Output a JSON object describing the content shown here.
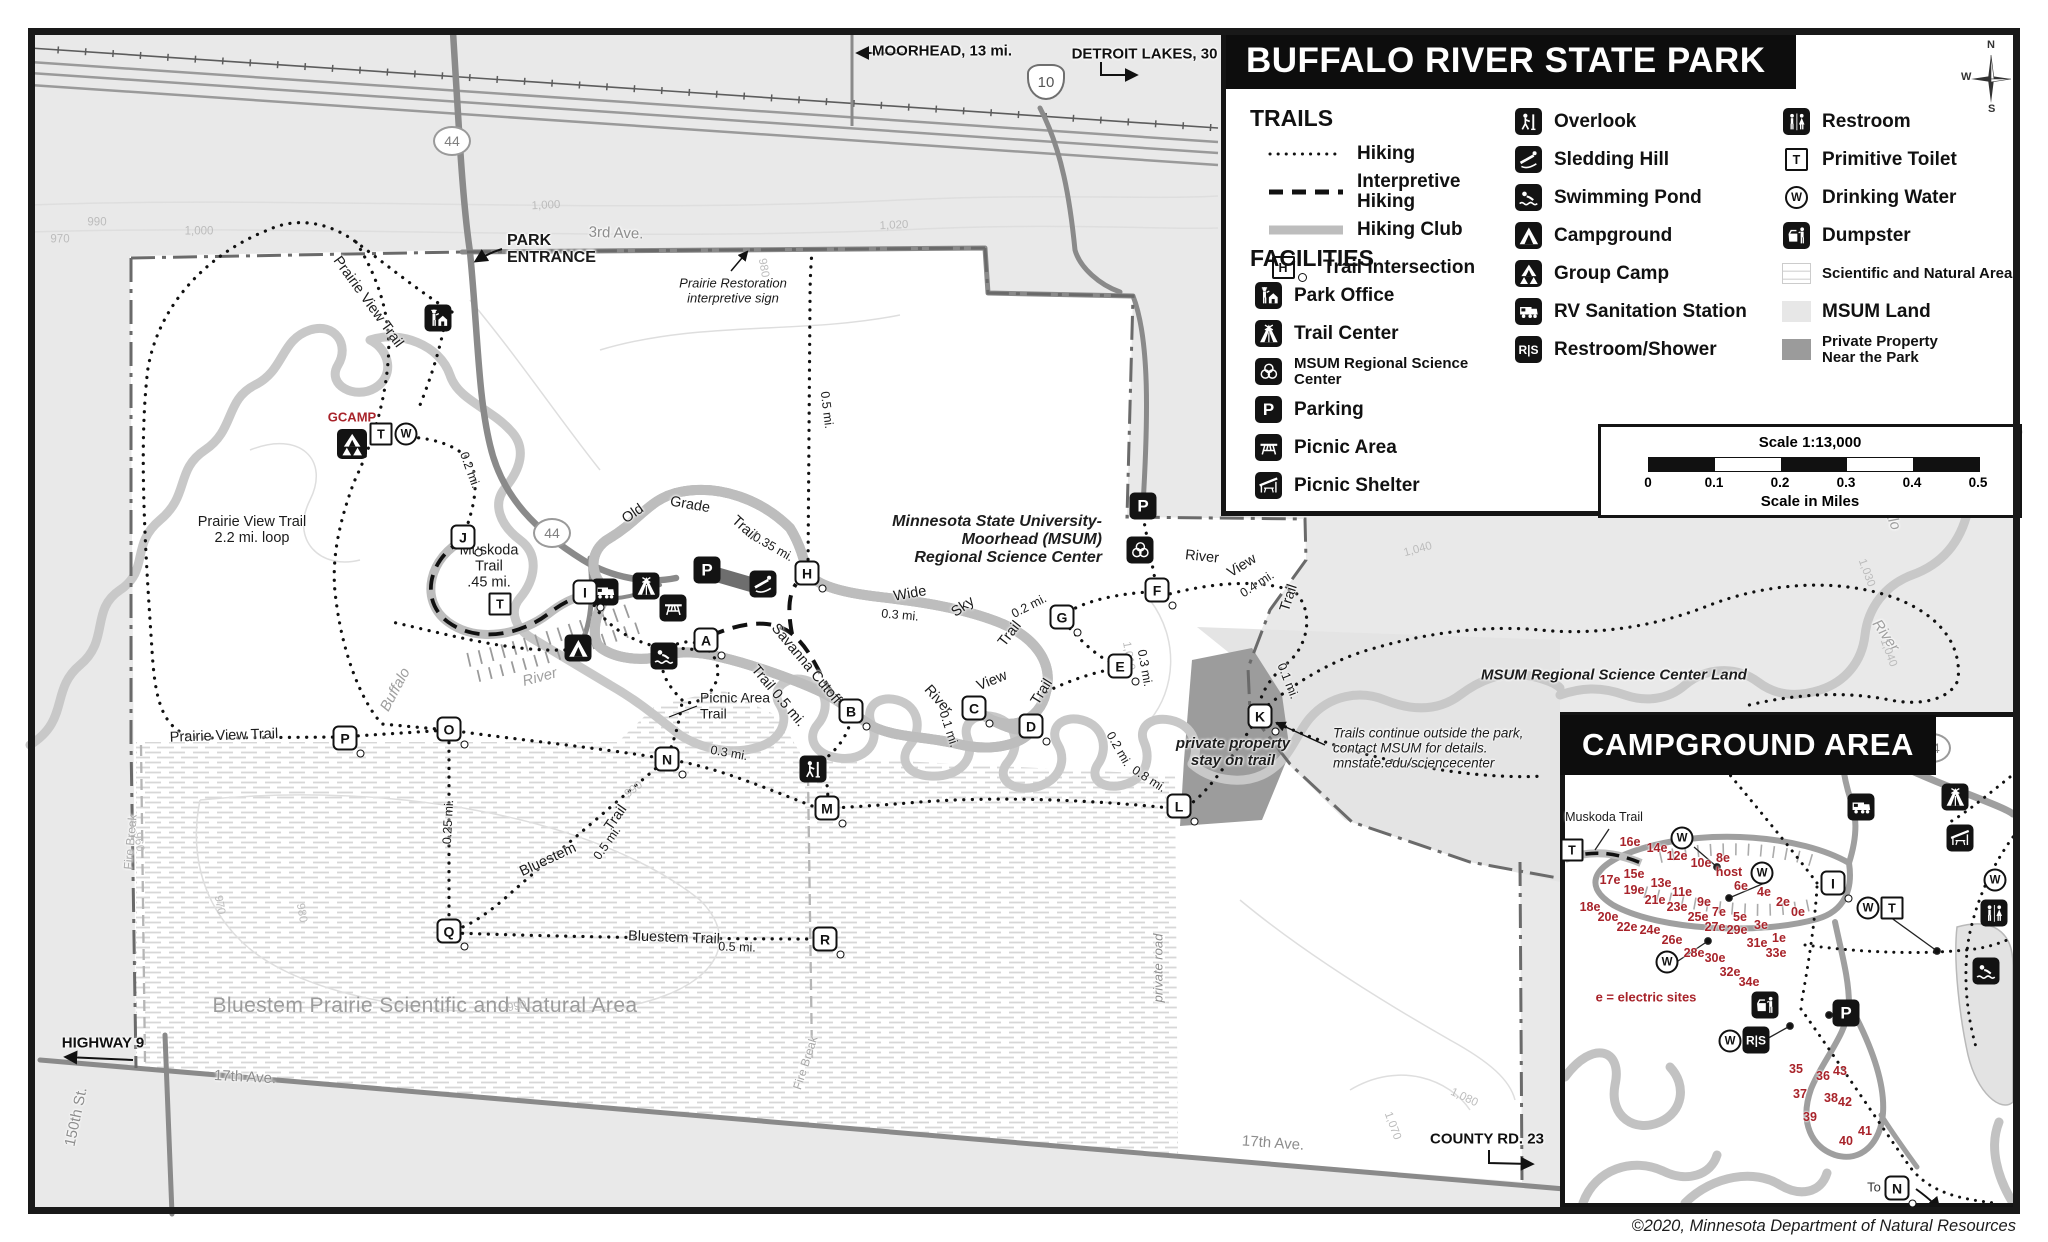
{
  "page": {
    "copyright": "©2020, Minnesota Department of Natural Resources"
  },
  "header": {
    "title": "BUFFALO RIVER STATE PARK"
  },
  "compass": {
    "n": "N",
    "e": "E",
    "s": "S",
    "w": "W"
  },
  "icon_glyphs": {
    "P": "P",
    "RS": "R|S",
    "T": "T",
    "W": "W",
    "H": "H"
  },
  "legend": {
    "trails_heading": "TRAILS",
    "trails": [
      {
        "style": "dotted",
        "label": "Hiking"
      },
      {
        "style": "dashed",
        "label": "Interpretive Hiking"
      },
      {
        "style": "club",
        "label": "Hiking Club"
      },
      {
        "style": "intersection",
        "symbol": "H",
        "label": "Trail Intersection"
      }
    ],
    "facilities_heading": "FACILITIES",
    "columns": [
      [
        {
          "icon": "b-office",
          "label": "Park Office"
        },
        {
          "icon": "b-lodge",
          "label": "Trail Center"
        },
        {
          "icon": "b-rings",
          "label": "MSUM Regional Science Center",
          "small": true
        },
        {
          "icon": "b-P",
          "label": "Parking"
        },
        {
          "icon": "b-picnic",
          "label": "Picnic Area"
        },
        {
          "icon": "b-shelter",
          "label": "Picnic Shelter"
        }
      ],
      [
        {
          "icon": "b-look",
          "label": "Overlook"
        },
        {
          "icon": "b-sled",
          "label": "Sledding Hill"
        },
        {
          "icon": "b-swim",
          "label": "Swimming Pond"
        },
        {
          "icon": "b-tent",
          "label": "Campground"
        },
        {
          "icon": "b-gcamp",
          "label": "Group Camp"
        },
        {
          "icon": "b-rv",
          "label": "RV Sanitation Station"
        },
        {
          "icon": "b-RS",
          "label": "Restroom/Shower"
        }
      ],
      [
        {
          "icon": "b-wc",
          "label": "Restroom"
        },
        {
          "icon": "w-T",
          "label": "Primitive Toilet"
        },
        {
          "icon": "c-W",
          "label": "Drinking Water"
        },
        {
          "icon": "b-dump",
          "label": "Dumpster"
        },
        {
          "icon": "sw-sna",
          "label": "Scientific and Natural Area",
          "small": true
        },
        {
          "icon": "sw-msum",
          "label": "MSUM Land"
        },
        {
          "icon": "sw-priv",
          "label": "Private Property\nNear the Park",
          "small": true
        }
      ]
    ]
  },
  "scalebar": {
    "title": "Scale 1:13,000",
    "ticks": [
      "0",
      "0.1",
      "0.2",
      "0.3",
      "0.4",
      "0.5"
    ],
    "caption": "Scale in Miles"
  },
  "inset": {
    "title": "CAMPGROUND AREA",
    "to_label": "To",
    "sites": [
      {
        "t": "16e",
        "x": 1630,
        "y": 842
      },
      {
        "t": "14e",
        "x": 1657,
        "y": 848
      },
      {
        "t": "12e",
        "x": 1677,
        "y": 856
      },
      {
        "t": "10e",
        "x": 1701,
        "y": 863
      },
      {
        "t": "8e",
        "x": 1723,
        "y": 858
      },
      {
        "t": "host",
        "x": 1729,
        "y": 872
      },
      {
        "t": "6e",
        "x": 1741,
        "y": 886
      },
      {
        "t": "4e",
        "x": 1764,
        "y": 892
      },
      {
        "t": "2e",
        "x": 1783,
        "y": 902
      },
      {
        "t": "0e",
        "x": 1798,
        "y": 912
      },
      {
        "t": "15e",
        "x": 1634,
        "y": 874
      },
      {
        "t": "13e",
        "x": 1661,
        "y": 883
      },
      {
        "t": "11e",
        "x": 1682,
        "y": 892
      },
      {
        "t": "9e",
        "x": 1704,
        "y": 902
      },
      {
        "t": "7e",
        "x": 1719,
        "y": 912
      },
      {
        "t": "5e",
        "x": 1740,
        "y": 917
      },
      {
        "t": "3e",
        "x": 1761,
        "y": 925
      },
      {
        "t": "1e",
        "x": 1779,
        "y": 938
      },
      {
        "t": "17e",
        "x": 1610,
        "y": 880
      },
      {
        "t": "19e",
        "x": 1634,
        "y": 890
      },
      {
        "t": "21e",
        "x": 1655,
        "y": 900
      },
      {
        "t": "23e",
        "x": 1677,
        "y": 907
      },
      {
        "t": "25e",
        "x": 1698,
        "y": 917
      },
      {
        "t": "27e",
        "x": 1715,
        "y": 927
      },
      {
        "t": "29e",
        "x": 1737,
        "y": 930
      },
      {
        "t": "31e",
        "x": 1757,
        "y": 943
      },
      {
        "t": "33e",
        "x": 1776,
        "y": 953
      },
      {
        "t": "18e",
        "x": 1590,
        "y": 907
      },
      {
        "t": "20e",
        "x": 1608,
        "y": 917
      },
      {
        "t": "22e",
        "x": 1627,
        "y": 927
      },
      {
        "t": "24e",
        "x": 1650,
        "y": 930
      },
      {
        "t": "26e",
        "x": 1672,
        "y": 940
      },
      {
        "t": "28e",
        "x": 1694,
        "y": 953
      },
      {
        "t": "30e",
        "x": 1715,
        "y": 958
      },
      {
        "t": "32e",
        "x": 1730,
        "y": 972
      },
      {
        "t": "34e",
        "x": 1749,
        "y": 982
      },
      {
        "t": "35",
        "x": 1796,
        "y": 1069
      },
      {
        "t": "36",
        "x": 1823,
        "y": 1076
      },
      {
        "t": "43",
        "x": 1840,
        "y": 1071
      },
      {
        "t": "37",
        "x": 1800,
        "y": 1094
      },
      {
        "t": "38",
        "x": 1831,
        "y": 1098
      },
      {
        "t": "42",
        "x": 1845,
        "y": 1102
      },
      {
        "t": "39",
        "x": 1810,
        "y": 1117
      },
      {
        "t": "40",
        "x": 1846,
        "y": 1141
      },
      {
        "t": "41",
        "x": 1865,
        "y": 1131
      }
    ]
  },
  "map": {
    "shields": [
      {
        "t": "10",
        "x": 1046,
        "y": 82,
        "us": 1
      },
      {
        "t": "44",
        "x": 452,
        "y": 141
      },
      {
        "t": "44",
        "x": 552,
        "y": 533
      },
      {
        "t": "44",
        "x": 1932,
        "y": 748
      }
    ],
    "intersections": [
      {
        "t": "A",
        "x": 706,
        "y": 640
      },
      {
        "t": "B",
        "x": 851,
        "y": 711
      },
      {
        "t": "C",
        "x": 974,
        "y": 708
      },
      {
        "t": "D",
        "x": 1031,
        "y": 726
      },
      {
        "t": "E",
        "x": 1120,
        "y": 666
      },
      {
        "t": "F",
        "x": 1157,
        "y": 590
      },
      {
        "t": "G",
        "x": 1062,
        "y": 617
      },
      {
        "t": "H",
        "x": 807,
        "y": 573
      },
      {
        "t": "I",
        "x": 585,
        "y": 592
      },
      {
        "t": "J",
        "x": 463,
        "y": 537
      },
      {
        "t": "K",
        "x": 1260,
        "y": 716
      },
      {
        "t": "L",
        "x": 1179,
        "y": 806
      },
      {
        "t": "M",
        "x": 827,
        "y": 808
      },
      {
        "t": "N",
        "x": 667,
        "y": 759
      },
      {
        "t": "O",
        "x": 449,
        "y": 729
      },
      {
        "t": "P",
        "x": 345,
        "y": 738
      },
      {
        "t": "Q",
        "x": 449,
        "y": 931
      },
      {
        "t": "R",
        "x": 825,
        "y": 939
      },
      {
        "t": "I",
        "x": 1833,
        "y": 883
      },
      {
        "t": "N",
        "x": 1897,
        "y": 1188
      }
    ],
    "icons": [
      {
        "k": "b-office",
        "x": 438,
        "y": 318
      },
      {
        "k": "b-gcamp",
        "x": 352,
        "y": 444,
        "s": 30
      },
      {
        "k": "w-T",
        "x": 381,
        "y": 434
      },
      {
        "k": "c-W",
        "x": 406,
        "y": 434
      },
      {
        "k": "b-rv",
        "x": 605,
        "y": 592
      },
      {
        "k": "b-lodge",
        "x": 646,
        "y": 586
      },
      {
        "k": "b-P",
        "x": 707,
        "y": 570
      },
      {
        "k": "b-picnic",
        "x": 673,
        "y": 608
      },
      {
        "k": "b-sled",
        "x": 763,
        "y": 584
      },
      {
        "k": "b-tent",
        "x": 578,
        "y": 648
      },
      {
        "k": "b-swim",
        "x": 664,
        "y": 656
      },
      {
        "k": "w-T",
        "x": 500,
        "y": 604
      },
      {
        "k": "b-P",
        "x": 1143,
        "y": 506
      },
      {
        "k": "b-rings",
        "x": 1140,
        "y": 550
      },
      {
        "k": "b-look",
        "x": 813,
        "y": 769
      },
      {
        "k": "b-rv",
        "x": 1861,
        "y": 807
      },
      {
        "k": "b-lodge",
        "x": 1955,
        "y": 797
      },
      {
        "k": "b-shelter",
        "x": 1960,
        "y": 838
      },
      {
        "k": "b-wc",
        "x": 1994,
        "y": 913
      },
      {
        "k": "b-swim",
        "x": 1986,
        "y": 971
      },
      {
        "k": "b-dump",
        "x": 1765,
        "y": 1005
      },
      {
        "k": "b-P",
        "x": 1846,
        "y": 1013
      },
      {
        "k": "b-RS",
        "x": 1756,
        "y": 1040
      },
      {
        "k": "c-W",
        "x": 1682,
        "y": 838
      },
      {
        "k": "c-W",
        "x": 1762,
        "y": 873
      },
      {
        "k": "c-W",
        "x": 1667,
        "y": 962
      },
      {
        "k": "c-W",
        "x": 1995,
        "y": 880
      },
      {
        "k": "c-W",
        "x": 1868,
        "y": 908
      },
      {
        "k": "c-W",
        "x": 1730,
        "y": 1041
      },
      {
        "k": "w-T",
        "x": 1572,
        "y": 850
      },
      {
        "k": "w-T",
        "x": 1892,
        "y": 908
      }
    ],
    "labels": [
      {
        "t": "MOORHEAD, 13 mi.",
        "x": 942,
        "y": 52,
        "c": "c-sign"
      },
      {
        "t": "DETROIT LAKES, 30 Mi.",
        "x": 1157,
        "y": 55,
        "c": "c-sign"
      },
      {
        "t": "HIGHWAY 9",
        "x": 103,
        "y": 1044,
        "c": "c-sign"
      },
      {
        "t": "COUNTY RD. 23",
        "x": 1487,
        "y": 1140,
        "c": "c-sign"
      },
      {
        "t": "PARK\nENTRANCE",
        "x": 507,
        "y": 250,
        "c": "c-pe",
        "a": "l"
      },
      {
        "t": "3rd Ave.",
        "x": 616,
        "y": 234,
        "r": 2,
        "c": "c-road"
      },
      {
        "t": "17th Ave.",
        "x": 245,
        "y": 1078,
        "r": 3,
        "c": "c-road"
      },
      {
        "t": "17th Ave.",
        "x": 1273,
        "y": 1144,
        "r": 4,
        "c": "c-road"
      },
      {
        "t": "150th St.",
        "x": 77,
        "y": 1117,
        "r": -78,
        "c": "c-road"
      },
      {
        "t": "private road",
        "x": 1159,
        "y": 968,
        "r": -90,
        "c": "c-roadi"
      },
      {
        "t": "Fire Break",
        "x": 131,
        "y": 842,
        "r": -85,
        "c": "c-fire"
      },
      {
        "t": "Fire Break",
        "x": 806,
        "y": 1063,
        "r": -72,
        "c": "c-fire"
      },
      {
        "t": "Prairie Restoration\ninterpretive sign",
        "x": 733,
        "y": 291,
        "c": "c-note"
      },
      {
        "t": "Trails continue outside the park,\ncontact MSUM for details.\nmnstate.edu/sciencecenter",
        "x": 1333,
        "y": 748,
        "c": "c-notel",
        "a": "l"
      },
      {
        "t": "Minnesota State University-\nMoorhead (MSUM)\nRegional Science Center",
        "x": 1102,
        "y": 540,
        "c": "c-msum",
        "a": "r"
      },
      {
        "t": "MSUM Regional Science Center Land",
        "x": 1614,
        "y": 676,
        "c": "c-bi"
      },
      {
        "t": "private property\nstay on trail",
        "x": 1233,
        "y": 753,
        "c": "c-bi"
      },
      {
        "t": "Bluestem Prairie Scientific and Natural Area",
        "x": 425,
        "y": 1006,
        "c": "c-sna"
      },
      {
        "t": "GCAMP",
        "x": 352,
        "y": 418,
        "c": "c-red"
      },
      {
        "t": "e = electric sites",
        "x": 1646,
        "y": 998,
        "c": "c-red"
      },
      {
        "t": "Prairie View Trail",
        "x": 368,
        "y": 302,
        "r": 54,
        "c": "c-trail"
      },
      {
        "t": "Prairie View Trail",
        "x": 224,
        "y": 736,
        "r": -2,
        "c": "c-trail"
      },
      {
        "t": "Prairie View Trail\n2.2 mi. loop",
        "x": 252,
        "y": 530,
        "c": "c-trailc"
      },
      {
        "t": "Muskoda\nTrail\n.45 mi.",
        "x": 489,
        "y": 567,
        "c": "c-trailc"
      },
      {
        "t": "Old",
        "x": 633,
        "y": 514,
        "r": -35,
        "c": "c-trail"
      },
      {
        "t": "Grade",
        "x": 690,
        "y": 505,
        "r": 10,
        "c": "c-trail"
      },
      {
        "t": "Trail",
        "x": 744,
        "y": 528,
        "r": 42,
        "c": "c-trail"
      },
      {
        "t": "Wide",
        "x": 910,
        "y": 594,
        "r": -10,
        "c": "c-trail"
      },
      {
        "t": "Sky",
        "x": 963,
        "y": 607,
        "r": -35,
        "c": "c-trail"
      },
      {
        "t": "Trail",
        "x": 1010,
        "y": 634,
        "r": -52,
        "c": "c-trail"
      },
      {
        "t": "Savanna Cutoff",
        "x": 806,
        "y": 664,
        "r": 50,
        "c": "c-trail"
      },
      {
        "t": "Trail 0.5 mi.",
        "x": 778,
        "y": 696,
        "r": 50,
        "c": "c-trail"
      },
      {
        "t": "Picnic Area\nTrail",
        "x": 700,
        "y": 706,
        "c": "c-traill",
        "a": "l"
      },
      {
        "t": "River",
        "x": 938,
        "y": 700,
        "r": 48,
        "c": "c-trail"
      },
      {
        "t": "View",
        "x": 992,
        "y": 681,
        "r": -22,
        "c": "c-trail"
      },
      {
        "t": "Trail",
        "x": 1042,
        "y": 692,
        "r": -58,
        "c": "c-trail"
      },
      {
        "t": "River",
        "x": 1202,
        "y": 557,
        "r": 6,
        "c": "c-trail"
      },
      {
        "t": "View",
        "x": 1242,
        "y": 566,
        "r": -32,
        "c": "c-trail"
      },
      {
        "t": "Trail",
        "x": 1289,
        "y": 598,
        "r": -72,
        "c": "c-trail"
      },
      {
        "t": "Bluestem",
        "x": 548,
        "y": 860,
        "r": -25,
        "c": "c-trail"
      },
      {
        "t": "Trail",
        "x": 616,
        "y": 818,
        "r": -55,
        "c": "c-trail"
      },
      {
        "t": "Bluestem Trail",
        "x": 674,
        "y": 938,
        "r": 2,
        "c": "c-trail"
      },
      {
        "t": "Muskoda Trail",
        "x": 1604,
        "y": 817,
        "c": "c-trails"
      },
      {
        "t": "0.2 mi.",
        "x": 470,
        "y": 470,
        "r": 70,
        "c": "c-dist"
      },
      {
        "t": "0.5 mi.",
        "x": 827,
        "y": 410,
        "r": 83,
        "c": "c-dist"
      },
      {
        "t": "0.35 mi.",
        "x": 773,
        "y": 547,
        "r": 30,
        "c": "c-dist"
      },
      {
        "t": "0.3 mi.",
        "x": 900,
        "y": 615,
        "r": 5,
        "c": "c-dist"
      },
      {
        "t": "0.2 mi.",
        "x": 1029,
        "y": 606,
        "r": -27,
        "c": "c-dist"
      },
      {
        "t": "0.3 mi.",
        "x": 1145,
        "y": 668,
        "r": 80,
        "c": "c-dist"
      },
      {
        "t": "0.4 mi.",
        "x": 1257,
        "y": 584,
        "r": -33,
        "c": "c-dist"
      },
      {
        "t": "0.1 mi.",
        "x": 1288,
        "y": 681,
        "r": 68,
        "c": "c-dist"
      },
      {
        "t": "0.2 mi.",
        "x": 1119,
        "y": 749,
        "r": 60,
        "c": "c-dist"
      },
      {
        "t": "0.1 mi.",
        "x": 949,
        "y": 729,
        "r": 72,
        "c": "c-dist"
      },
      {
        "t": "0.8 mi.",
        "x": 1149,
        "y": 779,
        "r": 33,
        "c": "c-dist"
      },
      {
        "t": "0.3 mi.",
        "x": 729,
        "y": 753,
        "r": 10,
        "c": "c-dist"
      },
      {
        "t": "0.25 mi.",
        "x": 448,
        "y": 822,
        "r": -87,
        "c": "c-dist"
      },
      {
        "t": "0.5 mi.",
        "x": 607,
        "y": 843,
        "r": -55,
        "c": "c-dist"
      },
      {
        "t": "0.5 mi.",
        "x": 737,
        "y": 947,
        "r": 2,
        "c": "c-dist"
      },
      {
        "t": "Buffalo",
        "x": 396,
        "y": 690,
        "r": -62,
        "c": "c-river"
      },
      {
        "t": "River",
        "x": 540,
        "y": 678,
        "r": -15,
        "c": "c-river"
      },
      {
        "t": "Buffalo",
        "x": 1887,
        "y": 508,
        "r": 68,
        "c": "c-river"
      },
      {
        "t": "River",
        "x": 1885,
        "y": 636,
        "r": 55,
        "c": "c-river"
      },
      {
        "t": "970",
        "x": 60,
        "y": 240,
        "c": "c-cont"
      },
      {
        "t": "990",
        "x": 97,
        "y": 223,
        "c": "c-cont"
      },
      {
        "t": "1,000",
        "x": 199,
        "y": 232,
        "c": "c-cont"
      },
      {
        "t": "1,000",
        "x": 546,
        "y": 206,
        "r": -3,
        "c": "c-cont"
      },
      {
        "t": "1,020",
        "x": 894,
        "y": 226,
        "r": -3,
        "c": "c-cont"
      },
      {
        "t": "980",
        "x": 763,
        "y": 268,
        "r": 80,
        "c": "c-cont"
      },
      {
        "t": "1,010",
        "x": 1128,
        "y": 656,
        "r": 80,
        "c": "c-cont"
      },
      {
        "t": "1,040",
        "x": 1418,
        "y": 550,
        "r": -15,
        "c": "c-cont"
      },
      {
        "t": "1,030",
        "x": 1866,
        "y": 573,
        "r": 70,
        "c": "c-cont"
      },
      {
        "t": "1,040",
        "x": 1888,
        "y": 653,
        "r": 70,
        "c": "c-cont"
      },
      {
        "t": "1,070",
        "x": 1392,
        "y": 1126,
        "r": 70,
        "c": "c-cont"
      },
      {
        "t": "1,080",
        "x": 1464,
        "y": 1098,
        "r": 25,
        "c": "c-cont"
      },
      {
        "t": "960",
        "x": 138,
        "y": 842,
        "r": 80,
        "c": "c-cont"
      },
      {
        "t": "970",
        "x": 219,
        "y": 905,
        "r": 80,
        "c": "c-cont"
      },
      {
        "t": "980",
        "x": 301,
        "y": 913,
        "r": 80,
        "c": "c-cont"
      },
      {
        "t": "990",
        "x": 517,
        "y": 1007,
        "r": -10,
        "c": "c-cont"
      },
      {
        "t": "990",
        "x": 634,
        "y": 790,
        "r": -38,
        "c": "c-cont"
      },
      {
        "t": "To",
        "x": 1874,
        "y": 1188,
        "c": "c-to"
      }
    ]
  }
}
